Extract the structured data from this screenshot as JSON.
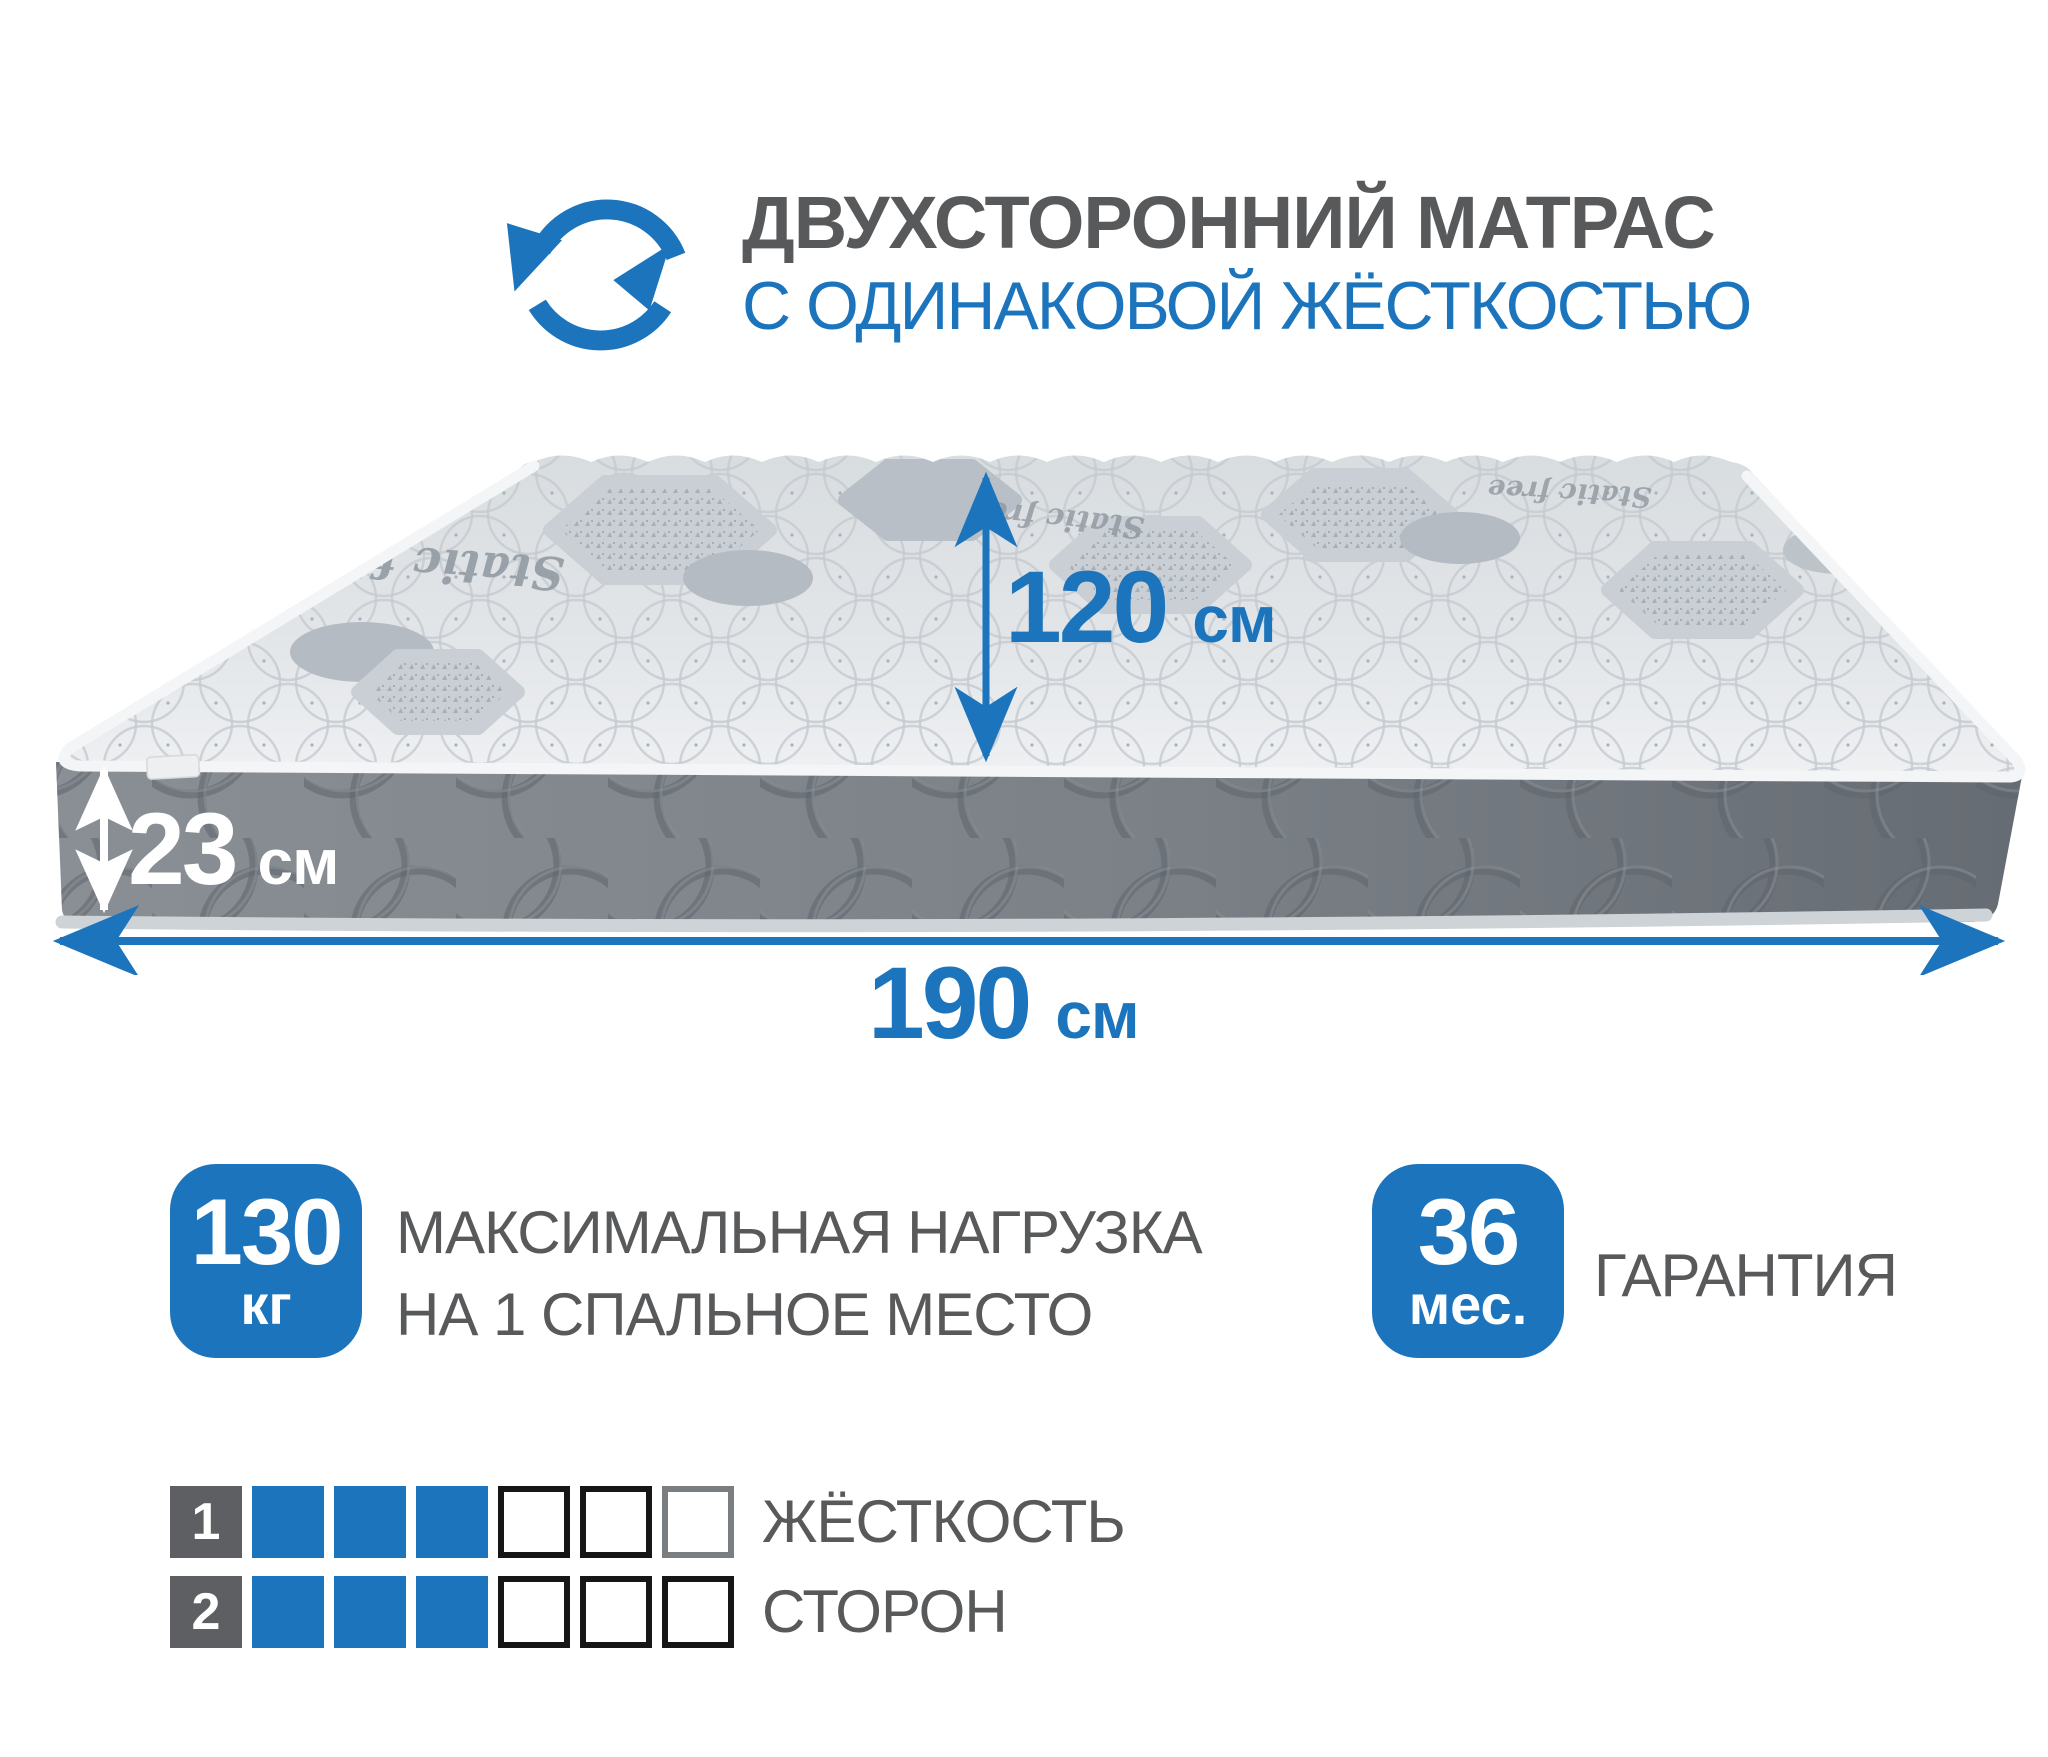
{
  "colors": {
    "accent_blue": "#1c75bc",
    "text_gray": "#58595b"
  },
  "header": {
    "icon": "rotate-arrows-icon",
    "title_line1": "ДВУХСТОРОННИЙ МАТРАС",
    "title_line2": "С ОДИНАКОВОЙ ЖЁСТКОСТЬЮ"
  },
  "mattress": {
    "fabric_text": "Static free"
  },
  "dimensions": {
    "width": {
      "value": "120",
      "unit": "см"
    },
    "thickness": {
      "value": "23",
      "unit": "см"
    },
    "length": {
      "value": "190",
      "unit": "см"
    }
  },
  "max_load": {
    "value": "130",
    "unit": "кг",
    "label_line1": "МАКСИМАЛЬНАЯ НАГРУЗКА",
    "label_line2": "НА 1 СПАЛЬНОЕ МЕСТО"
  },
  "warranty": {
    "value": "36",
    "unit": "мес.",
    "label": "ГАРАНТИЯ"
  },
  "firmness": {
    "label_line1": "ЖЁСТКОСТЬ",
    "label_line2": "СТОРОН",
    "scale_max": 6,
    "rows": [
      {
        "label": "1",
        "filled": 3
      },
      {
        "label": "2",
        "filled": 3
      }
    ]
  }
}
